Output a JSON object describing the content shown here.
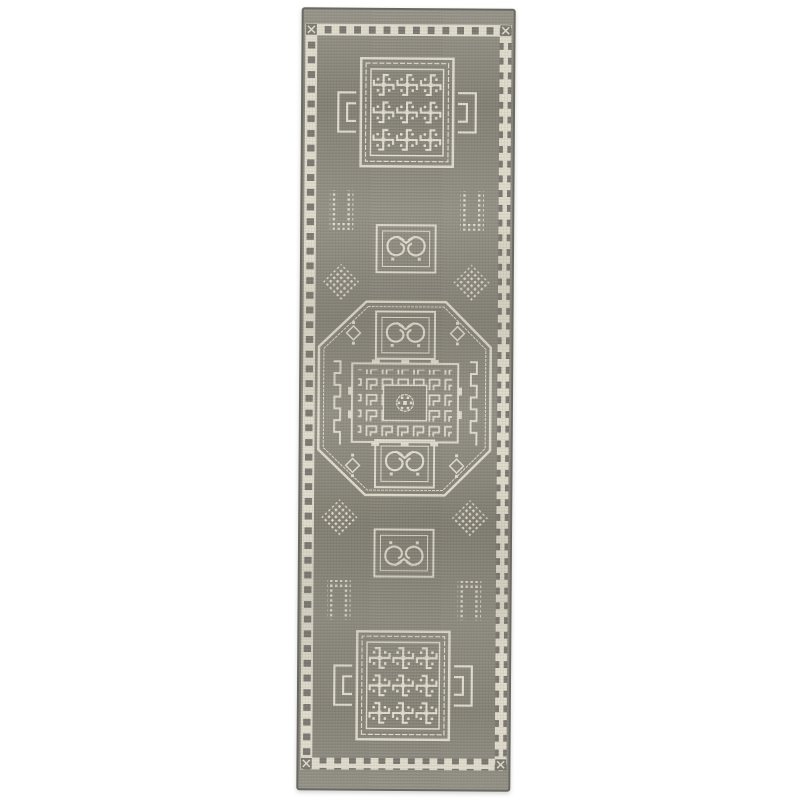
{
  "page": {
    "background": "#ffffff"
  },
  "rug": {
    "colors": {
      "field": "#8d8a7e",
      "field2": "#8a877b",
      "cream": "#e2decf",
      "bandsq": "#7d7b72",
      "edge": "#6b6a62"
    }
  }
}
